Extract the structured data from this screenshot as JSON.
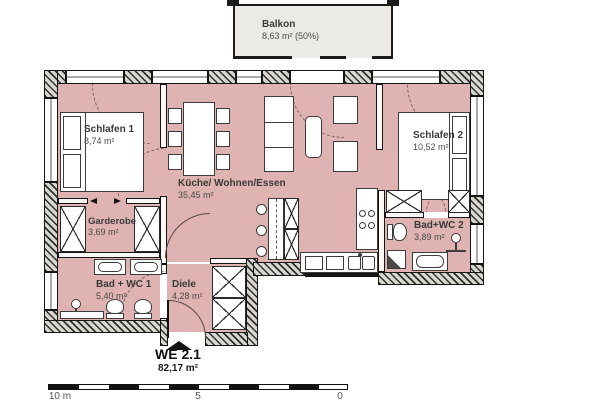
{
  "colors": {
    "floor": "#deb3b1",
    "balcony": "#eceae4",
    "wall_hatch_dark": "#30302e"
  },
  "balcony": {
    "name": "Balkon",
    "area": "8,63 m² (50%)"
  },
  "rooms": [
    {
      "name": "Schlafen 1",
      "area": "8,74 m²"
    },
    {
      "name": "Küche/ Wohnen/Essen",
      "area": "35,45 m²"
    },
    {
      "name": "Schlafen 2",
      "area": "10,52 m²"
    },
    {
      "name": "Garderobe",
      "area": "3,69 m²"
    },
    {
      "name": "Bad + WC 1",
      "area": "5,40 m²"
    },
    {
      "name": "Diele",
      "area": "4,28 m²"
    },
    {
      "name": "Bad+WC 2",
      "area": "3,89 m²"
    }
  ],
  "unit": {
    "label": "WE 2.1",
    "area": "82,17 m²"
  },
  "scale": {
    "left": "10 m",
    "mid": "5",
    "right": "0"
  }
}
